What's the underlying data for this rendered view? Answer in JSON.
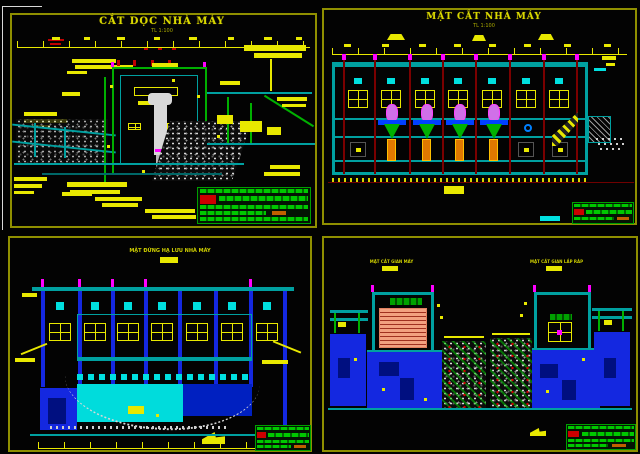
{
  "app": {
    "type": "cad-drawing-sheet",
    "background": "#000000"
  },
  "colors": {
    "frame": "#8f8f00",
    "dimension": "#e8e800",
    "structure_green": "#00b000",
    "structure_teal": "#00a0a0",
    "glass_cyan": "#00e0e0",
    "mass_blue": "#1428e0",
    "column_maroon": "#7a0000",
    "magenta": "#ff00ff",
    "generator_violet": "#d070e8",
    "pier_orange": "#e07800",
    "transformer_salmon": "#f2a080",
    "table_green": "#00c800",
    "stamp_red": "#cc0000"
  },
  "panels": {
    "top_left": {
      "title": "CẮT DỌC NHÀ MÁY",
      "subtitle": "TL 1:100"
    },
    "top_right": {
      "title": "MẶT CẮT NHÀ MÁY",
      "subtitle": "TL 1:100"
    },
    "bottom_left": {
      "title": "MẶT ĐỨNG HẠ LƯU NHÀ MÁY",
      "subtitle": "TL 1:100"
    },
    "bottom_right": {
      "left_title": "MẶT CẮT GIAN MÁY",
      "right_title": "MẶT CẮT GIAN LẮP RÁP"
    }
  }
}
